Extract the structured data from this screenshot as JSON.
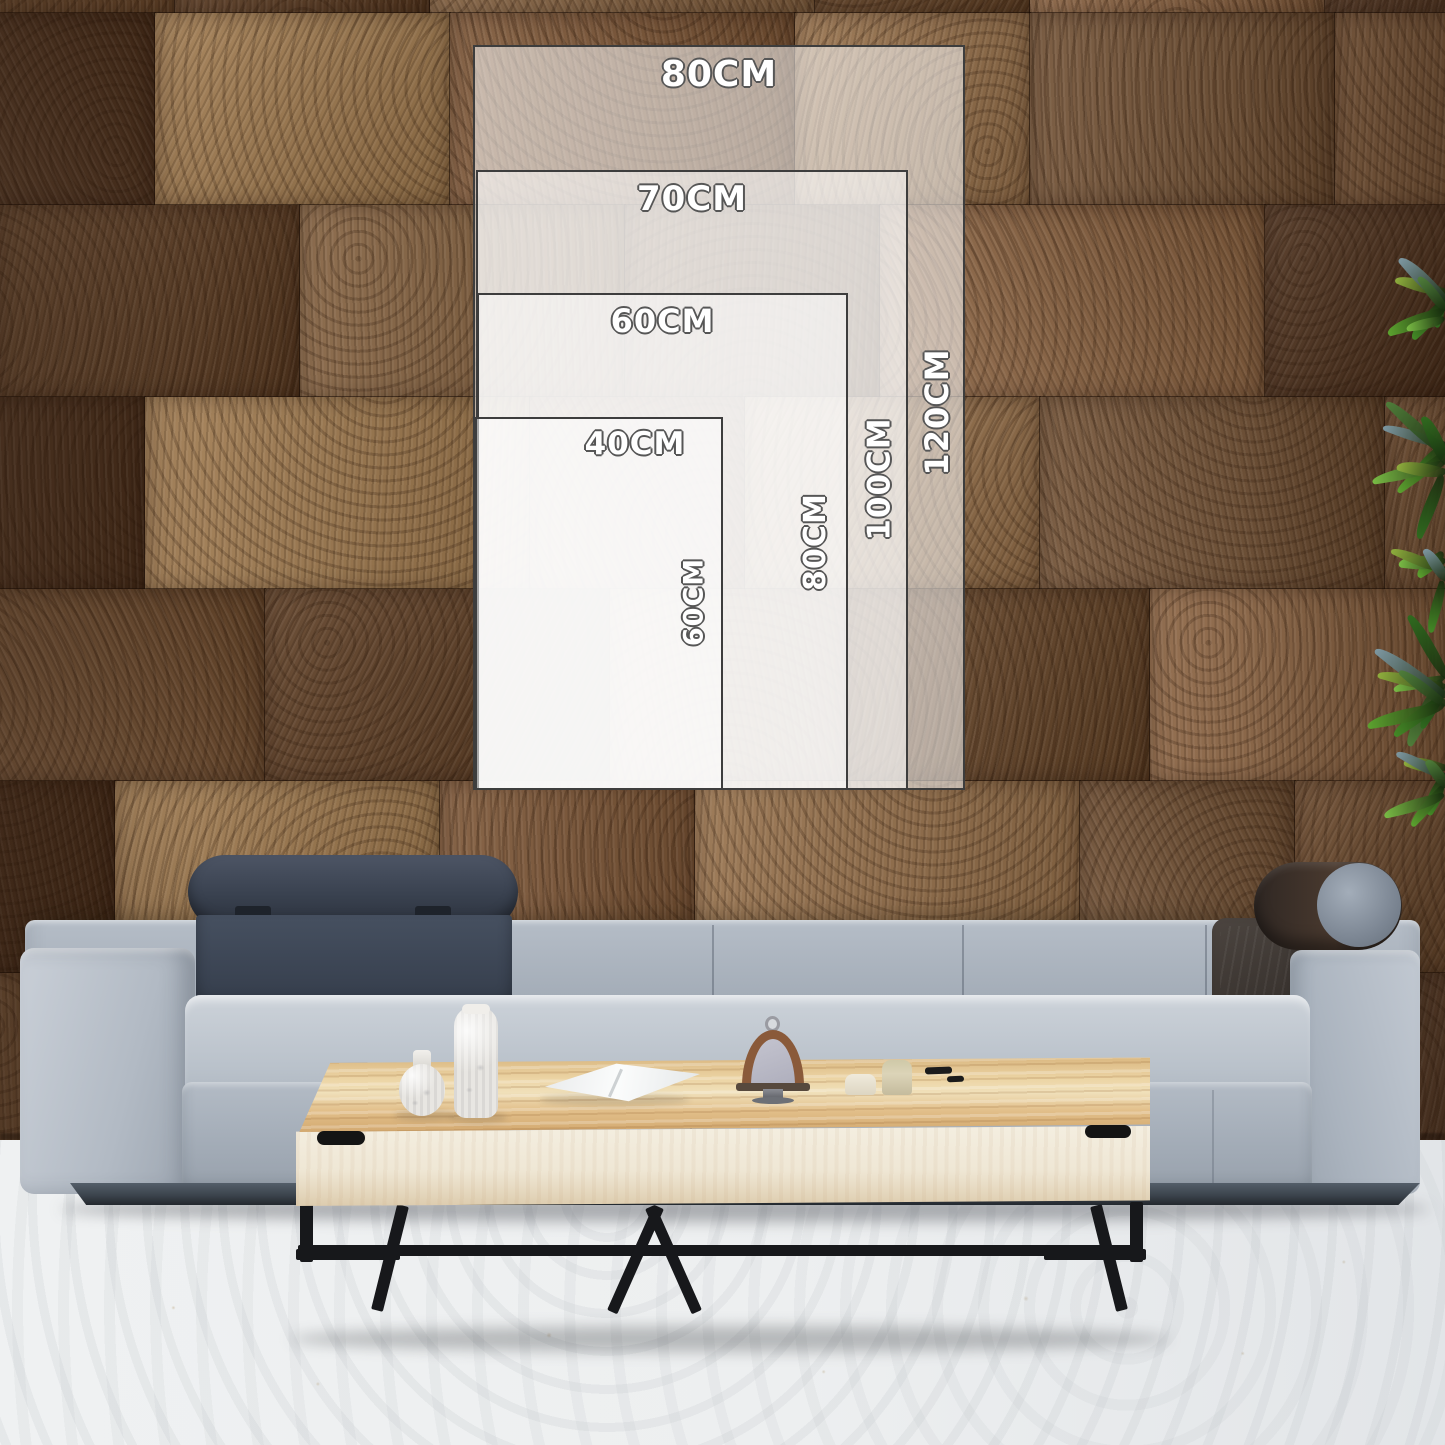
{
  "size_chart": {
    "sizes": [
      {
        "width_label": "80CM",
        "height_label": "120CM"
      },
      {
        "width_label": "70CM",
        "height_label": "100CM"
      },
      {
        "width_label": "60CM",
        "height_label": "80CM"
      },
      {
        "width_label": "40CM",
        "height_label": "60CM"
      }
    ]
  },
  "scene": {
    "wall_palette": [
      "#6e4b2d",
      "#7d5636",
      "#8a6240",
      "#5c3c22",
      "#96704a",
      "#4e311c",
      "#83603e",
      "#715033",
      "#a07a4e",
      "#654427"
    ],
    "leaf_palette": [
      "#2f6a1f",
      "#438a26",
      "#5ca32f",
      "#79bb45",
      "#8fae3d",
      "#7d97a1",
      "#4f7d3a"
    ],
    "colors": {
      "sofa_fabric": "#aab3be",
      "sofa_fabric_light": "#c7cdd5",
      "headrest_navy": "#3c4553",
      "bolster_brown": "#463931",
      "table_wood": "#e2c08c",
      "table_front": "#f1ebdc",
      "metal_leg": "#17181b",
      "floor": "#edeff0",
      "label_fill": "#ffffff",
      "label_outline": "#565656",
      "rect_border": "#3d3d3d"
    }
  }
}
